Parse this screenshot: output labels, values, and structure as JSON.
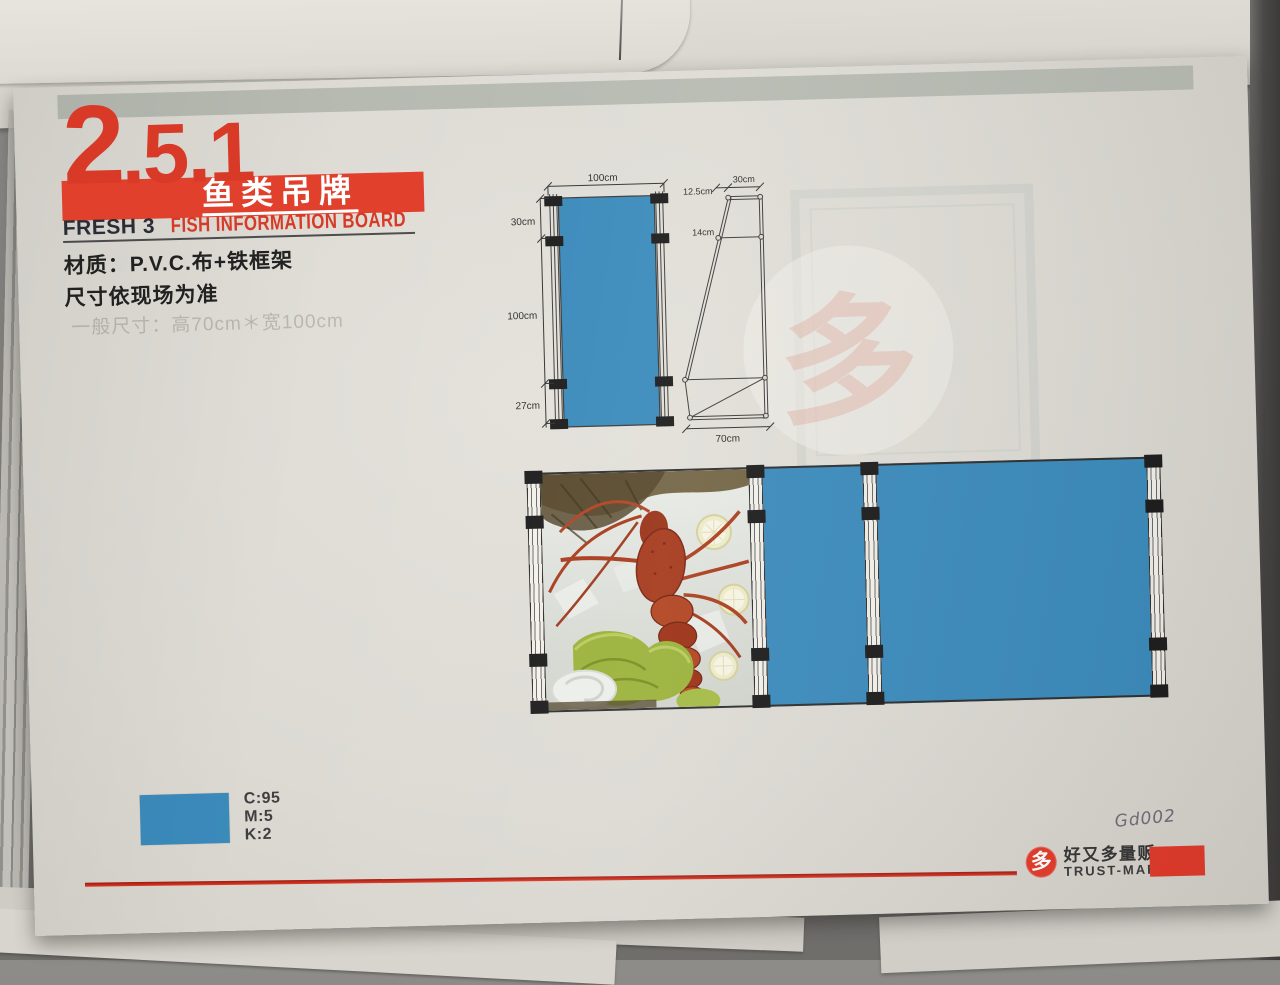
{
  "page": {
    "section_number_major": "2",
    "section_number_rest": ".5.1",
    "title_cn": "鱼类吊牌",
    "subtitle_left": "FRESH 3",
    "subtitle_right": "FISH INFORMATION BOARD",
    "material_line": "材质：P.V.C.布+铁框架",
    "size_line": "尺寸依现场为准",
    "ghost_line": "一般尺寸：高70cm＊宽100cm"
  },
  "front_view": {
    "top_width": "100cm",
    "seg_top": "30cm",
    "seg_mid": "100cm",
    "seg_bottom": "27cm"
  },
  "side_view": {
    "top_width": "30cm",
    "top_offset": "12.5cm",
    "upper_seg": "14cm",
    "bottom_width": "70cm"
  },
  "color_spec": {
    "c": "C:95",
    "m": "M:5",
    "k": "K:2"
  },
  "colors": {
    "blue": "#3a8abb",
    "accent_red": "#d93a27",
    "banner_red": "#e0402c",
    "gray_bar": "#b6bab1"
  },
  "mockup": {
    "photo_desc": "lobster-on-ice-with-lettuce-and-lemon"
  },
  "footer": {
    "handwritten": "Gd002",
    "logo_char": "多",
    "brand_cn": "好又多量贩",
    "brand_en": "TRUST-MART"
  }
}
